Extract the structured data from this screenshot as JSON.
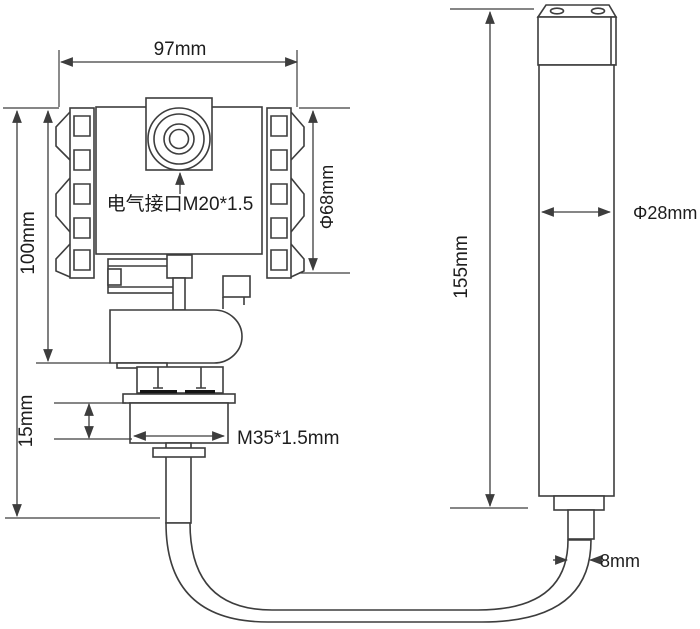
{
  "drawing": {
    "colors": {
      "line": "#3d3d3d",
      "text": "#1d1d1d",
      "seal": "#141414",
      "background": "#ffffff"
    },
    "labels": {
      "housing_width": "97mm",
      "housing_height": "100mm",
      "housing_diameter": "Φ68mm",
      "electrical_port": "电气接口M20*1.5",
      "thread_height": "15mm",
      "thread_spec": "M35*1.5mm",
      "probe_length": "155mm",
      "probe_diameter": "Φ28mm",
      "cable_diameter": "8mm"
    }
  }
}
